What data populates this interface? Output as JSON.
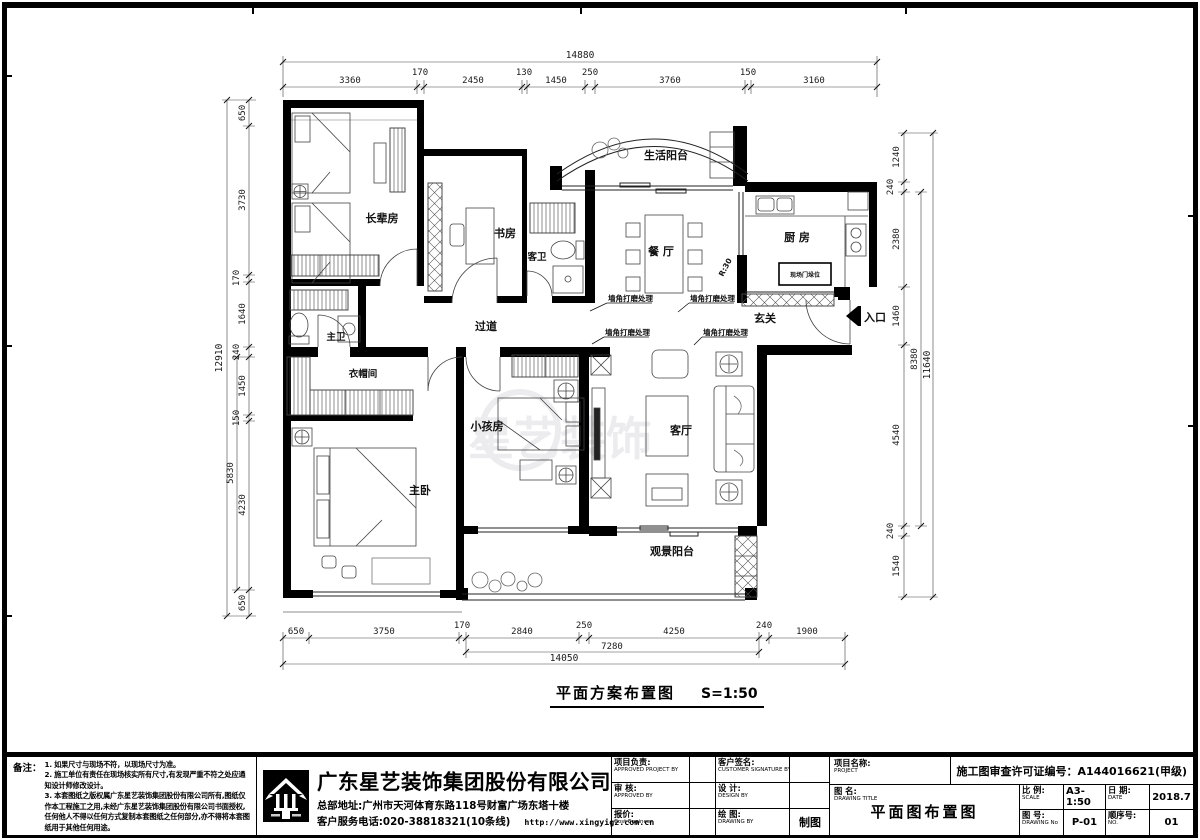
{
  "plan": {
    "title": "平面方案布置图",
    "scale": "S=1:50",
    "watermark": "星艺装饰"
  },
  "rooms": {
    "elder_bedroom": "长辈房",
    "study": "书房",
    "guest_bath": "客卫",
    "life_balcony": "生活阳台",
    "dining": "餐 厅",
    "kitchen": "厨 房",
    "foyer": "玄关",
    "entry": "入口",
    "corridor": "过道",
    "master_bath": "主卫",
    "cloakroom": "衣帽间",
    "kids_room": "小孩房",
    "master_bedroom": "主卧",
    "living": "客厅",
    "view_balcony": "观景阳台"
  },
  "annotations": {
    "corner_note": "墙角打磨处理",
    "door_label": "现场门垛位",
    "radius_note": "R:30"
  },
  "dims": {
    "top": {
      "overall": "14880",
      "segments": [
        "3360",
        "170",
        "2450",
        "130",
        "1450",
        "250",
        "3760",
        "150",
        "3160"
      ]
    },
    "left": {
      "overall": "12910",
      "mid": "5830",
      "segments": [
        "650",
        "3730",
        "170",
        "1640",
        "240",
        "1450",
        "150",
        "4230",
        "650"
      ]
    },
    "right": {
      "overall": "11640",
      "mid": "8380",
      "segments": [
        "1240",
        "240",
        "2380",
        "1460",
        "4540",
        "240",
        "1540"
      ]
    },
    "bottom": {
      "overall": "14050",
      "mid": "7280",
      "segments": [
        "650",
        "3750",
        "170",
        "2840",
        "250",
        "4250",
        "240",
        "1900"
      ]
    }
  },
  "titleblock": {
    "notes_label": "备注：",
    "notes": [
      "1. 如果尺寸与现场不符，以现场尺寸为准。",
      "2. 施工单位有责任在现场核实所有尺寸,有发现严重不符之处应通知设计师修改设计。",
      "3. 本套图纸之版权属广东星艺装饰集团股份有限公司所有,图纸仅作本工程施工之用,未经广东星艺装饰集团股份有限公司书面授权,任何他人不得以任何方式复制本套图纸之任何部分,亦不得将本套图纸用于其他任何用途。"
    ],
    "company": "广东星艺装饰集团股份有限公司",
    "address": "总部地址:广州市天河体育东路118号财富广场东塔十楼",
    "phone": "客户服务电话:020-38818321(10条线)",
    "website": "http://www.xingyigz.com.cn",
    "cells": {
      "pm_label": "项目负责:",
      "pm_en": "APPROVED PROJECT BY",
      "customer_label": "客户签名:",
      "customer_en": "CUSTOMER SIGNATURE BY",
      "review_label": "审 核:",
      "review_en": "APPROVED BY",
      "design_label": "设 计:",
      "design_en": "DESIGN BY",
      "quote_label": "报价:",
      "quote_en": "Cost Engineer",
      "draw_label": "绘 图:",
      "draw_en": "DRAWING BY",
      "draw_value": "制图",
      "project_label": "项目名称:",
      "project_en": "PROJECT",
      "dwgtitle_label": "图 名:",
      "dwgtitle_en": "DRAWING  TITLE",
      "dwgtitle_value": "平面图布置图",
      "license": "施工图审查许可证编号：A144016621(甲级)",
      "scale_label": "比 例:",
      "scale_en": "SCALE",
      "scale_value": "A3-1:50",
      "date_label": "日 期:",
      "date_en": "DATE",
      "date_value": "2018.7",
      "dwgno_label": "图 号:",
      "dwgno_en": "DRAWING No",
      "dwgno_value": "P-01",
      "seq_label": "顺序号:",
      "seq_en": "NO.",
      "seq_value": "01"
    }
  }
}
